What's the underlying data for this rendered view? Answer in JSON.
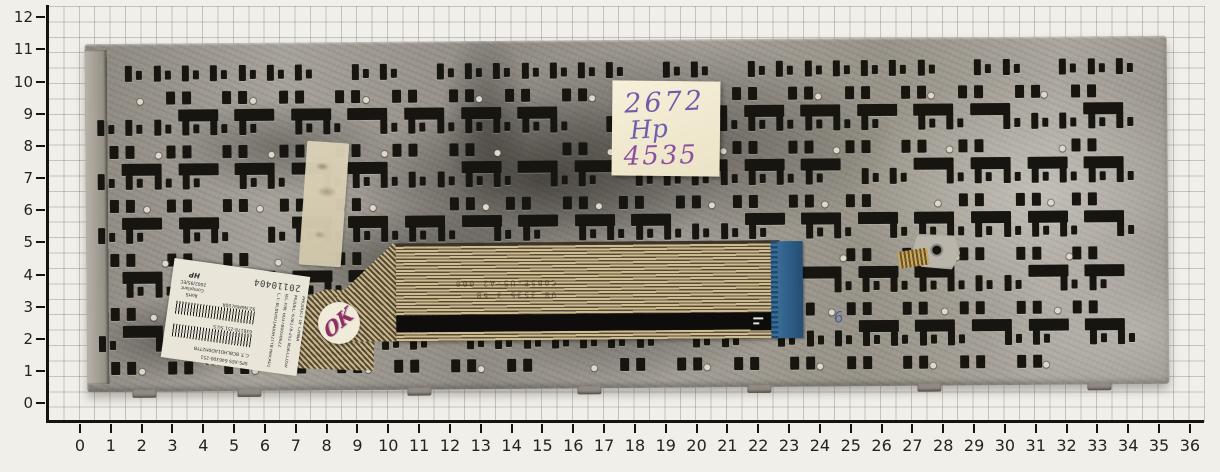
{
  "scene": {
    "description": "replacement laptop keyboard, rear metal plate with flex ribbon cable, photographed on centimeter grid paper with rulers"
  },
  "rulers": {
    "x_labels": [
      "0",
      "1",
      "2",
      "3",
      "4",
      "5",
      "6",
      "7",
      "8",
      "9",
      "10",
      "11",
      "12",
      "13",
      "14",
      "15",
      "16",
      "17",
      "18",
      "19",
      "20",
      "21",
      "22",
      "23",
      "24",
      "25",
      "26",
      "27",
      "28",
      "29",
      "30",
      "31",
      "32",
      "33",
      "34",
      "35",
      "36"
    ],
    "y_labels": [
      "0",
      "1",
      "2",
      "3",
      "4",
      "5",
      "6",
      "7",
      "8",
      "9",
      "10",
      "11",
      "12"
    ]
  },
  "sticky_note": {
    "lines": [
      "2672",
      "Hp",
      "4535"
    ]
  },
  "inspection_sticker": {
    "text": "OK"
  },
  "plate_handmark": {
    "text": "6"
  },
  "product_label": {
    "stamp": "20110404",
    "lines_vertical": [
      "PRODUCT OF CHINA",
      "MODEL: 638178-251 NSK-CC0SV",
      "IEC P/N: 6037B0058622",
      "C.T: BCBLHD1AD0H2TYB Rev:A01"
    ],
    "line_sps": "SPS:XES 646300-251",
    "line_ct": "C.T: BCBLHD1AD0H2TYB",
    "barcode1_caption": "638178-251 SU.S",
    "barcode2_caption": "9Z.N6MSV.00R",
    "rohs": [
      "RoHS",
      "Compliant",
      "2002/95/EC"
    ],
    "brand": "HP"
  },
  "cable_print": [
    "98 3535-3 5B",
    "C0B5E-U5-A2 000"
  ],
  "colors": {
    "paper": "#f0efe9",
    "grid_line": "#6e695f",
    "plate_metal": "#9c988f",
    "cutout": "#17150f",
    "cable_trace": "#cdbb92",
    "connector_blue": "#336a94",
    "note_paper": "#f3ecd4",
    "handwriting_ink": "#7459ab",
    "qc_ink": "#8d2f63"
  }
}
